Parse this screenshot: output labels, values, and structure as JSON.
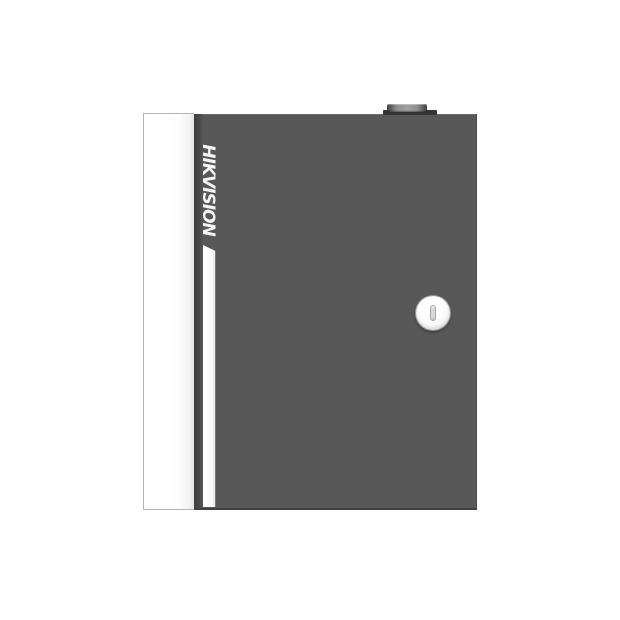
{
  "device": {
    "brand": "HIKVISION",
    "colors": {
      "background": "#ffffff",
      "door": "#585858",
      "door_edge": "#414141",
      "door_top_line": "#6b6b6b",
      "panel": "#fdfdfd",
      "panel_border": "#b3b3b3",
      "gap_dark": "#3e3e3e",
      "gap_light": "#575757",
      "stripe": "#fafafa",
      "stripe_edge": "#9a9a9a",
      "brand_text": "#f5f5f5",
      "lock_face": "#f6f6f6",
      "lock_ring": "#9a9a9a",
      "keyhole": "#d9d9d9",
      "keyhole_border": "#a6a6a6",
      "tab_base": "#353535",
      "tab_bar_mid": "#a0a0a0",
      "tab_bar_end": "#3f3f3f"
    }
  }
}
